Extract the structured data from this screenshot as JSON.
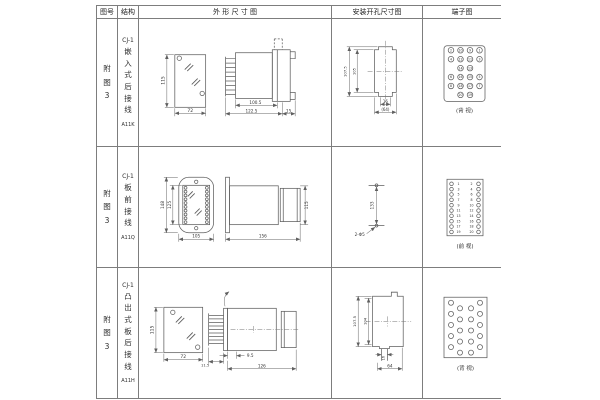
{
  "header": {
    "fig_no": "图号",
    "structure": "结构",
    "outline": "外 形 尺 寸 图",
    "install": "安装开孔尺寸图",
    "terminal": "端子图"
  },
  "rows": [
    {
      "fig": "附图3",
      "model": "CJ-1",
      "structure": "嵌入式后接线",
      "code": "A11K",
      "outline": {
        "front_h": "115",
        "front_w": "72",
        "side_a": "100.5",
        "side_b": "122.5",
        "side_c": "15"
      },
      "install": {
        "outer_h": "107.5",
        "inner_h": "105",
        "slot_w": "16",
        "outer_w": "(64)"
      },
      "terminal": {
        "view": "(背 视)",
        "nums": [
          "2",
          "10",
          "9",
          "1",
          "4",
          "12",
          "11",
          "3",
          "14",
          "13",
          "6",
          "16",
          "15",
          "5",
          "8",
          "18",
          "17",
          "7",
          "20",
          "19"
        ]
      }
    },
    {
      "fig": "附图3",
      "model": "CJ-1",
      "structure": "板前接线",
      "code": "A11Q",
      "outline": {
        "front_h1": "148",
        "front_h2": "125",
        "front_w": "105",
        "side_w": "156",
        "side_h": "115"
      },
      "install": {
        "spacing": "133",
        "holes": "2-Φ5"
      },
      "terminal": {
        "view": "(前 视)",
        "left": [
          "1",
          "3",
          "5",
          "7",
          "9",
          "11",
          "13",
          "15",
          "17",
          "19"
        ],
        "right": [
          "2",
          "4",
          "6",
          "8",
          "10",
          "12",
          "14",
          "16",
          "18",
          "20"
        ]
      }
    },
    {
      "fig": "附图3",
      "model": "CJ-1",
      "structure": "凸出式板后接线",
      "code": "A11H",
      "outline": {
        "front_h": "115",
        "front_w": "72",
        "side_a": "11.5",
        "side_b": "9.5",
        "side_c": "126"
      },
      "install": {
        "outer_h": "107.5",
        "inner_h": "104",
        "slot_w": "16",
        "outer_w": "64"
      },
      "terminal": {
        "view": "(背 视)"
      }
    }
  ]
}
